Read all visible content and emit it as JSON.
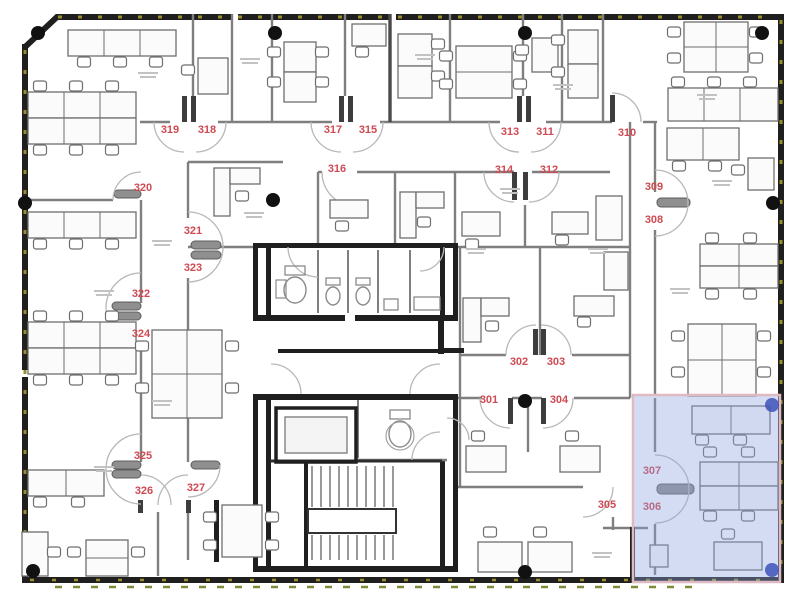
{
  "floor_plan": {
    "description": "Office floor plan, level 3",
    "room_labels": [
      {
        "id": "319",
        "x": 170,
        "y": 133
      },
      {
        "id": "318",
        "x": 207,
        "y": 133
      },
      {
        "id": "317",
        "x": 333,
        "y": 133
      },
      {
        "id": "315",
        "x": 368,
        "y": 133
      },
      {
        "id": "313",
        "x": 510,
        "y": 135
      },
      {
        "id": "311",
        "x": 545,
        "y": 135
      },
      {
        "id": "310",
        "x": 627,
        "y": 136
      },
      {
        "id": "316",
        "x": 337,
        "y": 172
      },
      {
        "id": "314",
        "x": 504,
        "y": 173
      },
      {
        "id": "312",
        "x": 549,
        "y": 173
      },
      {
        "id": "320",
        "x": 143,
        "y": 191
      },
      {
        "id": "309",
        "x": 654,
        "y": 190
      },
      {
        "id": "308",
        "x": 654,
        "y": 223
      },
      {
        "id": "321",
        "x": 193,
        "y": 234
      },
      {
        "id": "323",
        "x": 193,
        "y": 271
      },
      {
        "id": "322",
        "x": 141,
        "y": 297
      },
      {
        "id": "324",
        "x": 141,
        "y": 337
      },
      {
        "id": "302",
        "x": 519,
        "y": 365
      },
      {
        "id": "303",
        "x": 556,
        "y": 365
      },
      {
        "id": "301",
        "x": 489,
        "y": 403
      },
      {
        "id": "304",
        "x": 559,
        "y": 403
      },
      {
        "id": "325",
        "x": 143,
        "y": 459
      },
      {
        "id": "326",
        "x": 144,
        "y": 494
      },
      {
        "id": "327",
        "x": 196,
        "y": 491
      },
      {
        "id": "305",
        "x": 607,
        "y": 508
      },
      {
        "id": "307",
        "x": 652,
        "y": 474
      },
      {
        "id": "306",
        "x": 652,
        "y": 510
      }
    ],
    "selection": {
      "x": 633,
      "y": 395,
      "width": 147,
      "height": 187
    },
    "colors": {
      "room_label": "#cf4a52",
      "wall": "#1f1f1f",
      "partition": "#7f7f7f",
      "window_dash": "#9a8d2e",
      "window_dash_2": "#7e8c3a",
      "furniture": "#6e6e6e",
      "door_arc": "#b8b8b8",
      "door_leaf": "#8f8f8f",
      "column": "#111111",
      "selection_fill": "#8fa3e0",
      "selection_opacity": "0.38",
      "selection_border": "#debac2",
      "selection_dot": "#3d52b8"
    }
  }
}
